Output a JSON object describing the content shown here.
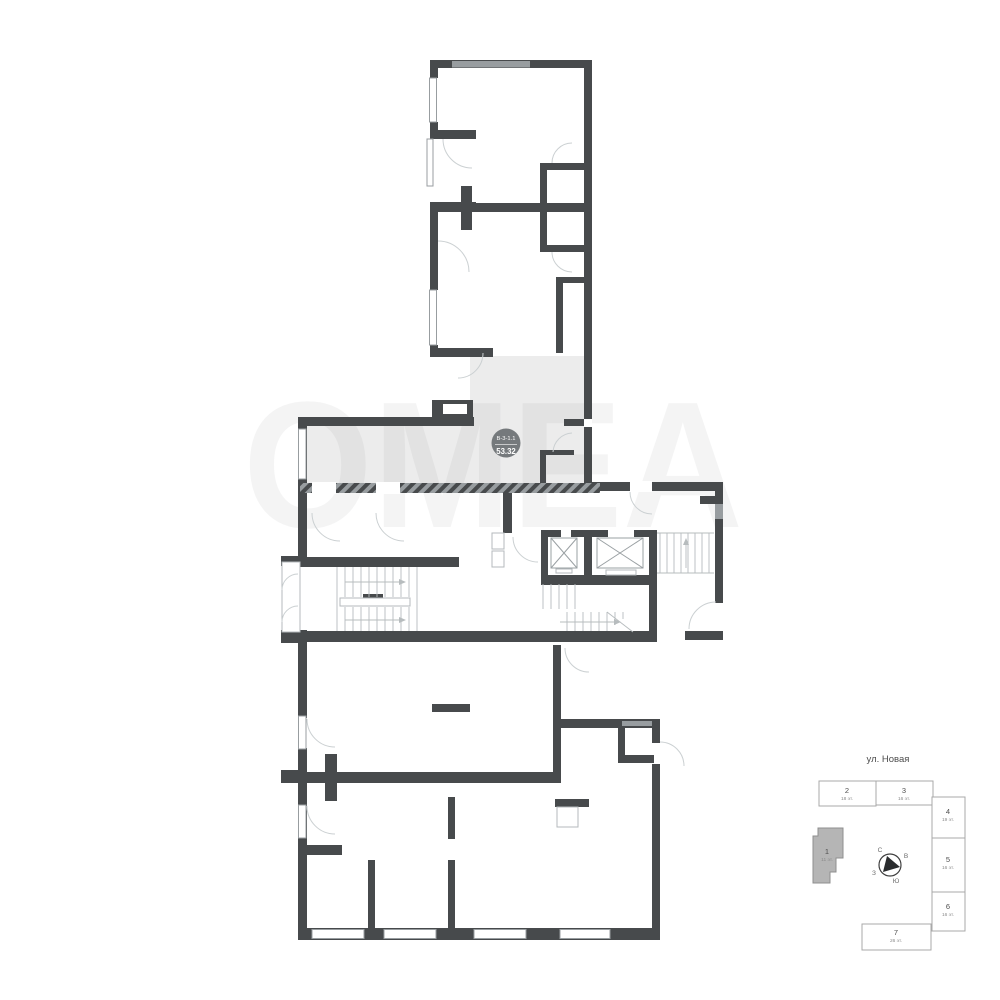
{
  "badge": {
    "code": "В-3-1.1",
    "area": "53.32"
  },
  "watermark": "ОМЕА",
  "minimap": {
    "street": "ул. Новая",
    "compass": {
      "n": "С",
      "e": "В",
      "s": "Ю",
      "w": "З"
    },
    "buildings": [
      {
        "num": "1",
        "floors": "11 эт.",
        "highlighted": true
      },
      {
        "num": "2",
        "floors": "18 эт.",
        "highlighted": false
      },
      {
        "num": "3",
        "floors": "16 эт.",
        "highlighted": false
      },
      {
        "num": "4",
        "floors": "19 эт.",
        "highlighted": false
      },
      {
        "num": "5",
        "floors": "16 эт.",
        "highlighted": false
      },
      {
        "num": "6",
        "floors": "16 эт.",
        "highlighted": false
      },
      {
        "num": "7",
        "floors": "26 эт.",
        "highlighted": false
      }
    ]
  },
  "colors": {
    "wall": "#474a4c",
    "unit_fill": "#ececec",
    "badge_bg": "#6f7376",
    "window": "#989da0",
    "minimap_highlight": "#b5b5b5"
  }
}
